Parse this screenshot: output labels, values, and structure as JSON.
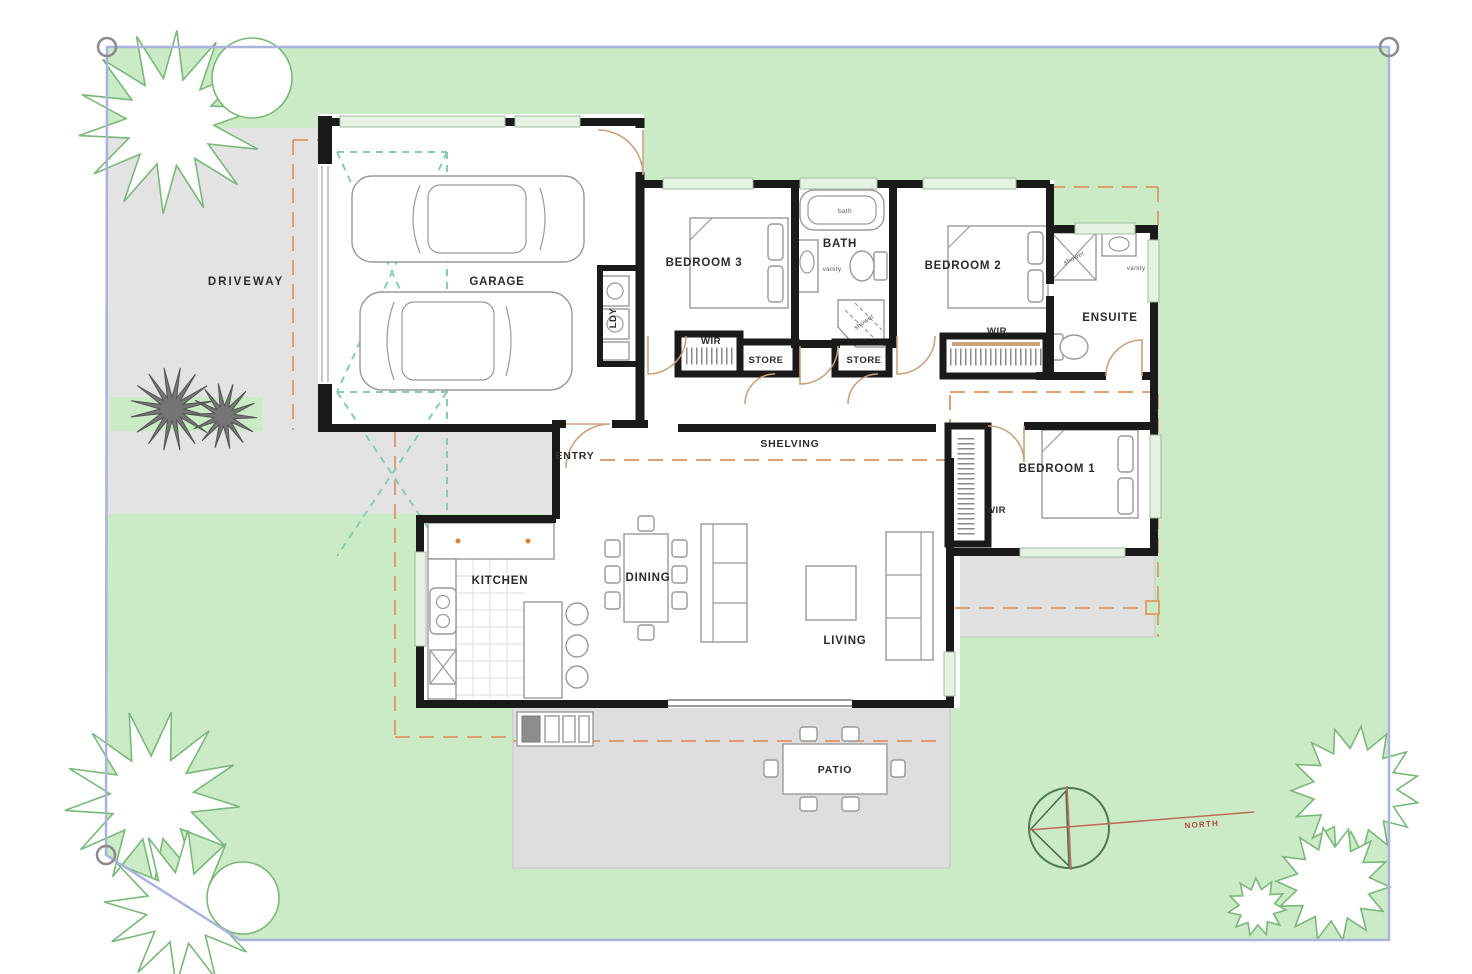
{
  "site": {
    "driveway": "DRIVEWAY",
    "patio": "PATIO",
    "north": "NORTH"
  },
  "rooms": {
    "garage": "GARAGE",
    "bedroom3": "BEDROOM 3",
    "bath": "BATH",
    "bedroom2": "BEDROOM 2",
    "ensuite": "ENSUITE",
    "entry": "ENTRY",
    "bedroom1": "BEDROOM 1",
    "kitchen": "KITCHEN",
    "dining": "DINING",
    "living": "LIVING",
    "laundry": "LDY"
  },
  "storage": {
    "wir_bed3": "WIR",
    "store_1": "STORE",
    "store_2": "STORE",
    "wir_bed2": "WIR",
    "wir_bed1": "WIR",
    "shelving": "SHELVING"
  },
  "fixtures": {
    "bath": "bath",
    "vanity": "vanity",
    "shower": "shower",
    "ensuite_shower": "shower",
    "ensuite_vanity": "vanity"
  },
  "colors": {
    "lawn": "#cbeac6",
    "hardscape": "#e3e3e3",
    "patio": "#dedede",
    "wall": "#1a1a1a",
    "boundary": "#a9b3dd",
    "setback_dash": "#dd9f72",
    "turning_dash": "#86cbb6",
    "door_arc": "#c9a27e",
    "north_line": "#c06a5a",
    "north_text": "#b5483c",
    "tree_outline": "#79b879",
    "window_fill": "#e6f2e2",
    "furniture": "#9a9a9a"
  }
}
